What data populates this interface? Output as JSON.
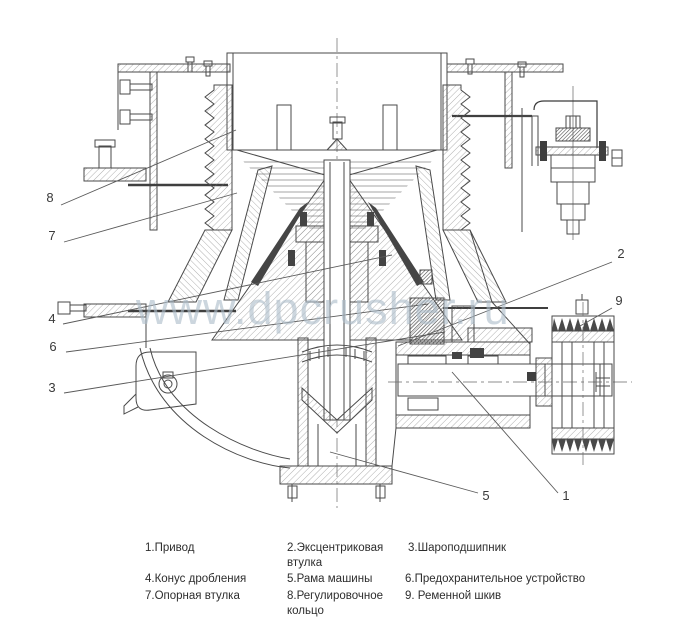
{
  "watermark": {
    "text": "www.dpcrusher.ru",
    "color": "#aebecb"
  },
  "diagram": {
    "subject": "cone-crusher-cross-section",
    "line_color": "#4a4a4a",
    "background": "#ffffff",
    "callouts": [
      {
        "num": "1",
        "label": "Привод",
        "lx": 566,
        "ly": 500,
        "line": [
          558,
          493,
          452,
          372
        ]
      },
      {
        "num": "2",
        "label": "Эксцентриковая втулка",
        "lx": 621,
        "ly": 258,
        "line": [
          612,
          262,
          398,
          346
        ]
      },
      {
        "num": "3",
        "label": "Шароподшипник",
        "lx": 52,
        "ly": 392,
        "line": [
          64,
          393,
          445,
          332
        ]
      },
      {
        "num": "4",
        "label": "Конус дробления",
        "lx": 52,
        "ly": 323,
        "line": [
          63,
          324,
          392,
          255
        ]
      },
      {
        "num": "5",
        "label": "Рама машины",
        "lx": 486,
        "ly": 500,
        "line": [
          478,
          493,
          330,
          452
        ]
      },
      {
        "num": "6",
        "label": "Предохранительное устройство",
        "lx": 53,
        "ly": 351,
        "line": [
          66,
          352,
          428,
          304
        ]
      },
      {
        "num": "7",
        "label": "Опорная втулка",
        "lx": 52,
        "ly": 240,
        "line": [
          64,
          242,
          237,
          193
        ]
      },
      {
        "num": "8",
        "label": "Регулировочное кольцо",
        "lx": 50,
        "ly": 202,
        "line": [
          61,
          205,
          236,
          130
        ]
      },
      {
        "num": "9",
        "label": "Ременной шкив",
        "lx": 619,
        "ly": 305,
        "line": [
          612,
          308,
          580,
          326
        ]
      }
    ]
  },
  "legend": {
    "items": [
      {
        "text": "1.Привод",
        "x": 145,
        "y": 541,
        "w": 130
      },
      {
        "text": "2.Эксцентриковая втулка",
        "x": 287,
        "y": 541,
        "w": 112
      },
      {
        "text": "3.Шароподшипник",
        "x": 408,
        "y": 541,
        "w": 170
      },
      {
        "text": "4.Конус дробления",
        "x": 145,
        "y": 572,
        "w": 140
      },
      {
        "text": "5.Рама машины",
        "x": 287,
        "y": 572,
        "w": 120
      },
      {
        "text": "6.Предохранительное устройство",
        "x": 405,
        "y": 572,
        "w": 240
      },
      {
        "text": "7.Опорная втулка",
        "x": 145,
        "y": 589,
        "w": 140
      },
      {
        "text": "8.Регулировочное кольцо",
        "x": 287,
        "y": 589,
        "w": 112
      },
      {
        "text": "9. Ременной шкив",
        "x": 405,
        "y": 589,
        "w": 170
      }
    ]
  }
}
